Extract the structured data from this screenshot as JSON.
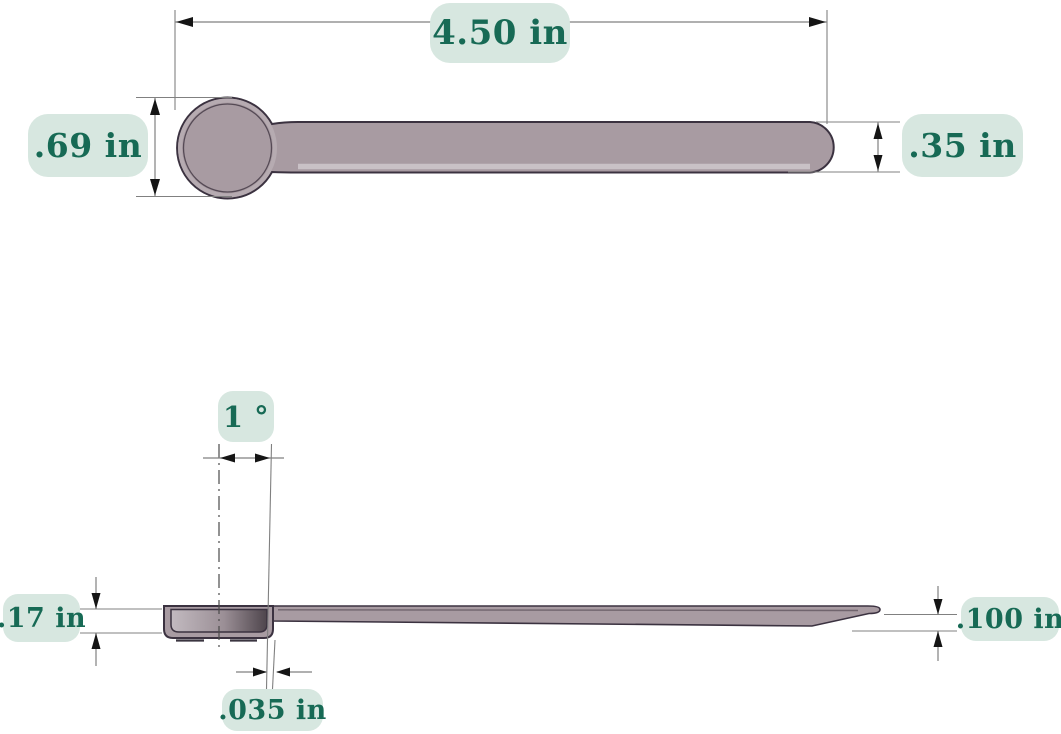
{
  "labels": {
    "overall_length": "4.50 in",
    "bowl_diameter": ".69 in",
    "handle_width": ".35 in",
    "taper_angle": "1 °",
    "bowl_depth": ".17 in",
    "tip_thickness": ".100 in",
    "wall_thickness": ".035 in"
  },
  "colors": {
    "pill_bg": "#d7e7e0",
    "pill_text": "#176a55",
    "spoon_fill": "#a89ba2",
    "spoon_fill_light": "#c9c1c6",
    "spoon_outline": "#3b3240",
    "dim_line": "#808080",
    "arrow": "#151515",
    "background": "#ffffff"
  }
}
